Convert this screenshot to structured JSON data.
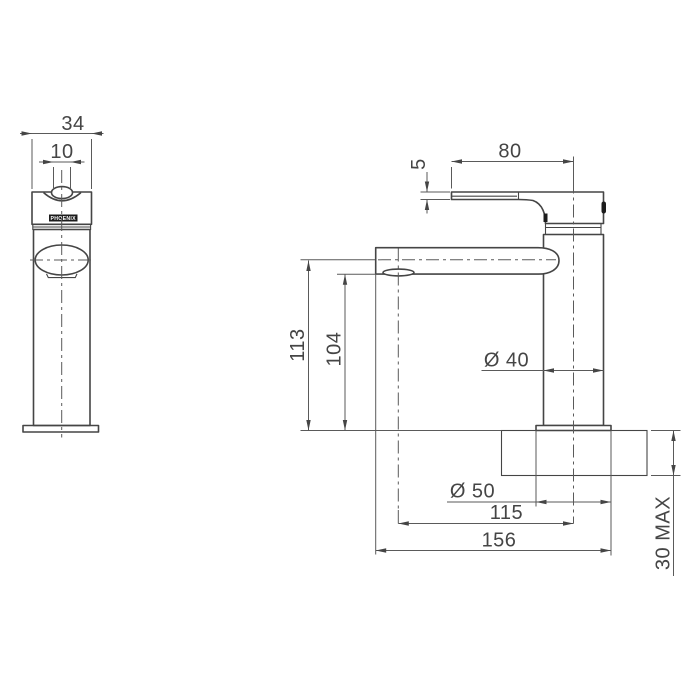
{
  "colors": {
    "line": "#454545",
    "thin": "#5a5a5a",
    "text": "#454545",
    "mark": "#1c1c1c",
    "bg": "#ffffff"
  },
  "drawing": {
    "description": "Basin mixer tap technical dimension drawing, front and side views",
    "front_view": {
      "logo_text": "PHOENIX",
      "dimensions": {
        "overall_width": "34",
        "handle_width": "10"
      }
    },
    "side_view": {
      "dimensions": {
        "handle_length": "80",
        "handle_thickness": "5",
        "spout_centre_height": "113",
        "outlet_clearance_height": "104",
        "body_diameter": "Ø 40",
        "base_diameter": "Ø 50",
        "spout_reach": "115",
        "overall_depth": "156",
        "deck_thickness_max": "30 MAX"
      }
    }
  }
}
